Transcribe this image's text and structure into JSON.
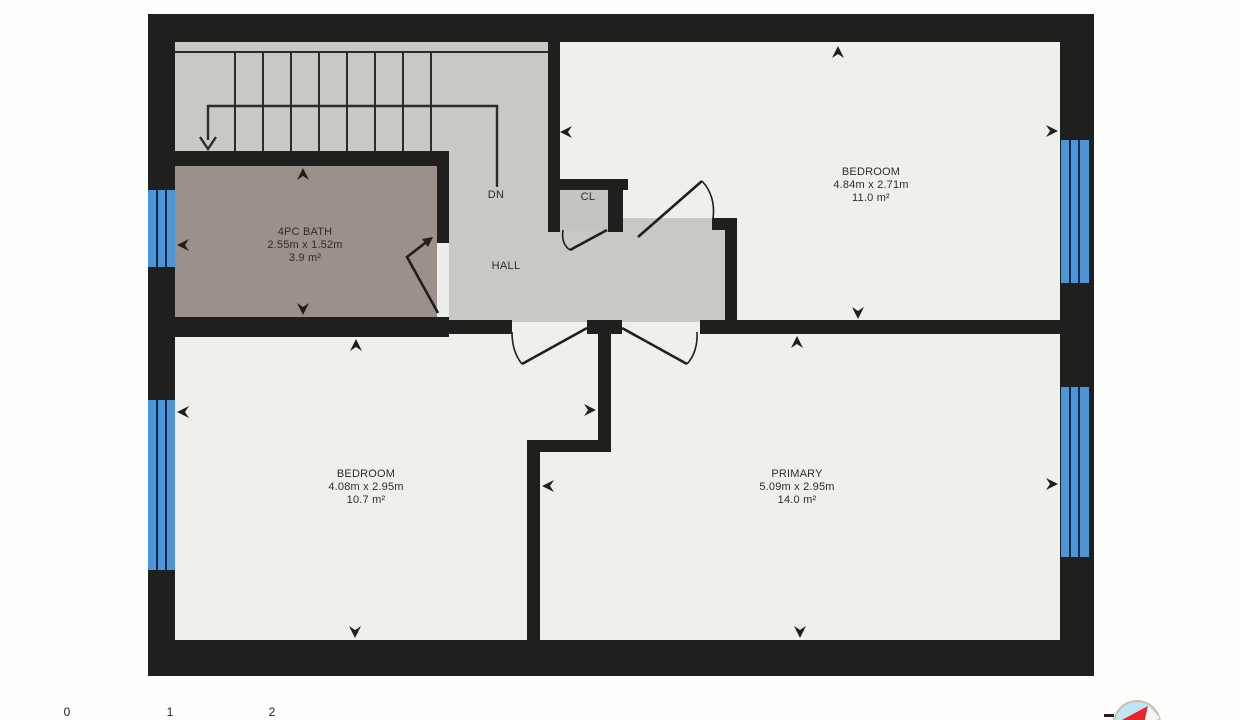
{
  "plan": {
    "title": "second floor plan",
    "rooms": {
      "bath": {
        "name": "4PC BATH",
        "dims": "2.55m x 1.52m",
        "area": "3.9 m²"
      },
      "bedroom_top": {
        "name": "BEDROOM",
        "dims": "4.84m x 2.71m",
        "area": "11.0 m²"
      },
      "bedroom_bottom": {
        "name": "BEDROOM",
        "dims": "4.08m x 2.95m",
        "area": "10.7 m²"
      },
      "primary": {
        "name": "PRIMARY",
        "dims": "5.09m x 2.95m",
        "area": "14.0 m²"
      },
      "hall": {
        "name": "HALL"
      },
      "closet": {
        "name": "CL"
      },
      "stairs": {
        "label": "DN"
      }
    },
    "scale_bar": {
      "labels": [
        "0",
        "1",
        "2"
      ]
    },
    "colors": {
      "wall": "#1f1f1d",
      "room_floor": "#efefec",
      "hall_floor": "#c9c8c5",
      "bath_floor": "#9a918a",
      "closet_floor": "#c6c4c1",
      "window": "#4a96d9",
      "compass_face": "#bfe4f4",
      "compass_needle": "#e5262c"
    }
  }
}
